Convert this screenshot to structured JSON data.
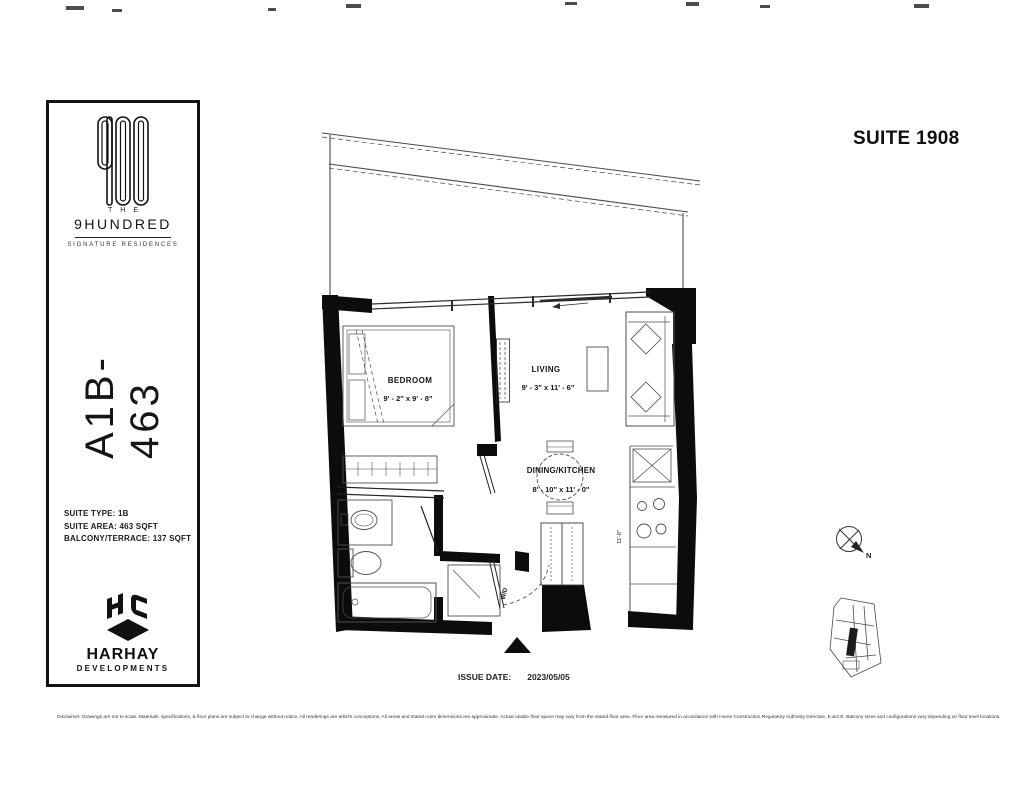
{
  "page": {
    "suite_title": "SUITE 1908",
    "issue_date_label": "ISSUE DATE:",
    "issue_date_value": "2023/05/05",
    "disclaimer": "Disclaimer: Drawings are not to scale. Materials, specifications, & floor plans are subject to change without notice. All renderings are artist's conceptions. All areas and stated room dimensions are approximate. Actual usable floor space may vary from the stated floor area. Floor area measured in accordance with Home Construction Regulatory Authority Directive, E.&O.E. Balcony sizes and configurations vary depending on floor level locations."
  },
  "sidebar": {
    "brand": {
      "the": "THE",
      "name": "9HUNDRED",
      "tagline": "SIGNATURE RESIDENCES"
    },
    "plan_code": "A1B-463",
    "specs": [
      "SUITE TYPE: 1B",
      "SUITE AREA: 463 SQFT",
      "BALCONY/TERRACE: 137 SQFT"
    ],
    "developer": {
      "name": "HARHAY",
      "subtitle": "DEVELOPMENTS"
    }
  },
  "floorplan": {
    "rooms": [
      {
        "name": "BEDROOM",
        "dims": "9' - 2\" x 9' - 8\""
      },
      {
        "name": "LIVING",
        "dims": "9' - 3\" x 11' - 6\""
      },
      {
        "name": "DINING/KITCHEN",
        "dims": "8' - 10\" x 11' - 0\""
      }
    ],
    "washer_dryer_label": "W/D",
    "kitchen_dim_label": "11'-0\"",
    "compass_north": "N"
  }
}
